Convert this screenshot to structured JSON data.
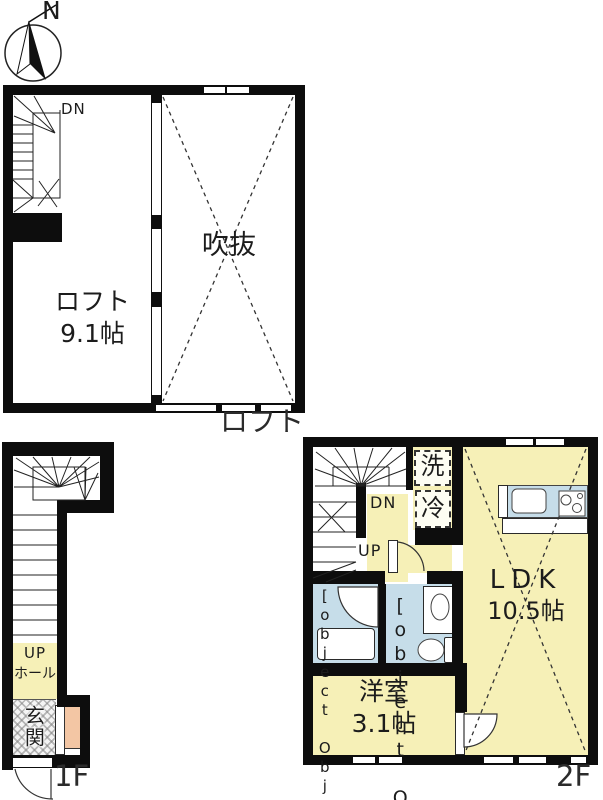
{
  "compass": {
    "north_label": "N"
  },
  "loft_plan": {
    "floor_label": "ロフト",
    "stairs_down_label": "DN",
    "loft_room": {
      "name": "ロフト",
      "area": "9.1帖"
    },
    "void_room": {
      "name": "吹抜"
    }
  },
  "first_floor_plan": {
    "floor_label": "1F",
    "stairs_up_label": "UP",
    "hall": {
      "name": "ホール"
    },
    "entrance": {
      "name": "玄関"
    }
  },
  "second_floor_plan": {
    "floor_label": "2F",
    "stairs_down_label": "DN",
    "stairs_up_label": "UP",
    "ldk": {
      "name": "LDK",
      "area": "10.5帖"
    },
    "western_room": {
      "name": "洋室",
      "area": "3.1帖"
    },
    "bathroom": {
      "name": "浴室"
    },
    "washroom": {
      "name": "洗面"
    },
    "washer_label": "洗",
    "fridge_label": "冷"
  },
  "colors": {
    "room_yellow": "#F6F0B7",
    "water_blue": "#C6DDE9",
    "salmon": "#F3C6A4",
    "wall_black": "#0d0d0d"
  }
}
